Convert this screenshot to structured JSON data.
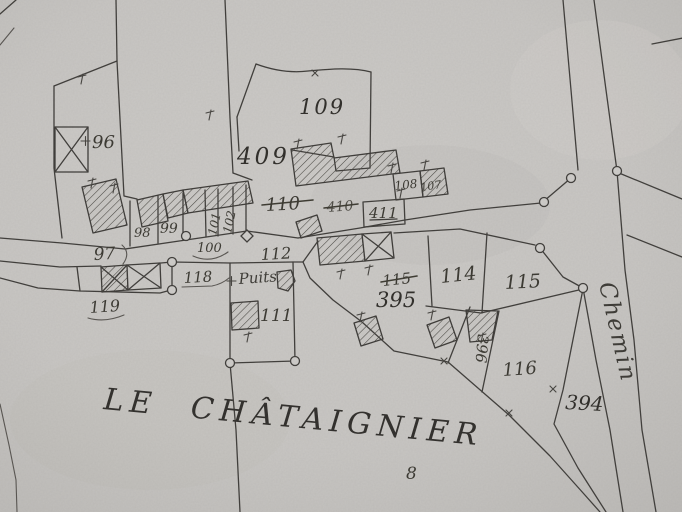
{
  "map": {
    "place_name": "LE CHÂTAIGNIER",
    "road_name": "Chemin",
    "well_label": "Puits",
    "section_number": "8",
    "labels": {
      "96": "96",
      "97": "97",
      "98": "98",
      "99": "99",
      "100": "100",
      "101": "101",
      "102": "102",
      "107": "107",
      "108": "108",
      "109": "109",
      "110": "110",
      "111": "111",
      "112": "112",
      "114": "114",
      "115": "115",
      "115_old": "115",
      "116": "116",
      "118": "118",
      "119": "119",
      "394": "394",
      "395": "395",
      "396": "396",
      "409": "409",
      "410": "410",
      "411": "411"
    },
    "crossed_out_labels": [
      "110",
      "410",
      "107",
      "115_old"
    ],
    "colors": {
      "paper": "#c9c7c4",
      "ink": "#3d3b38"
    }
  }
}
